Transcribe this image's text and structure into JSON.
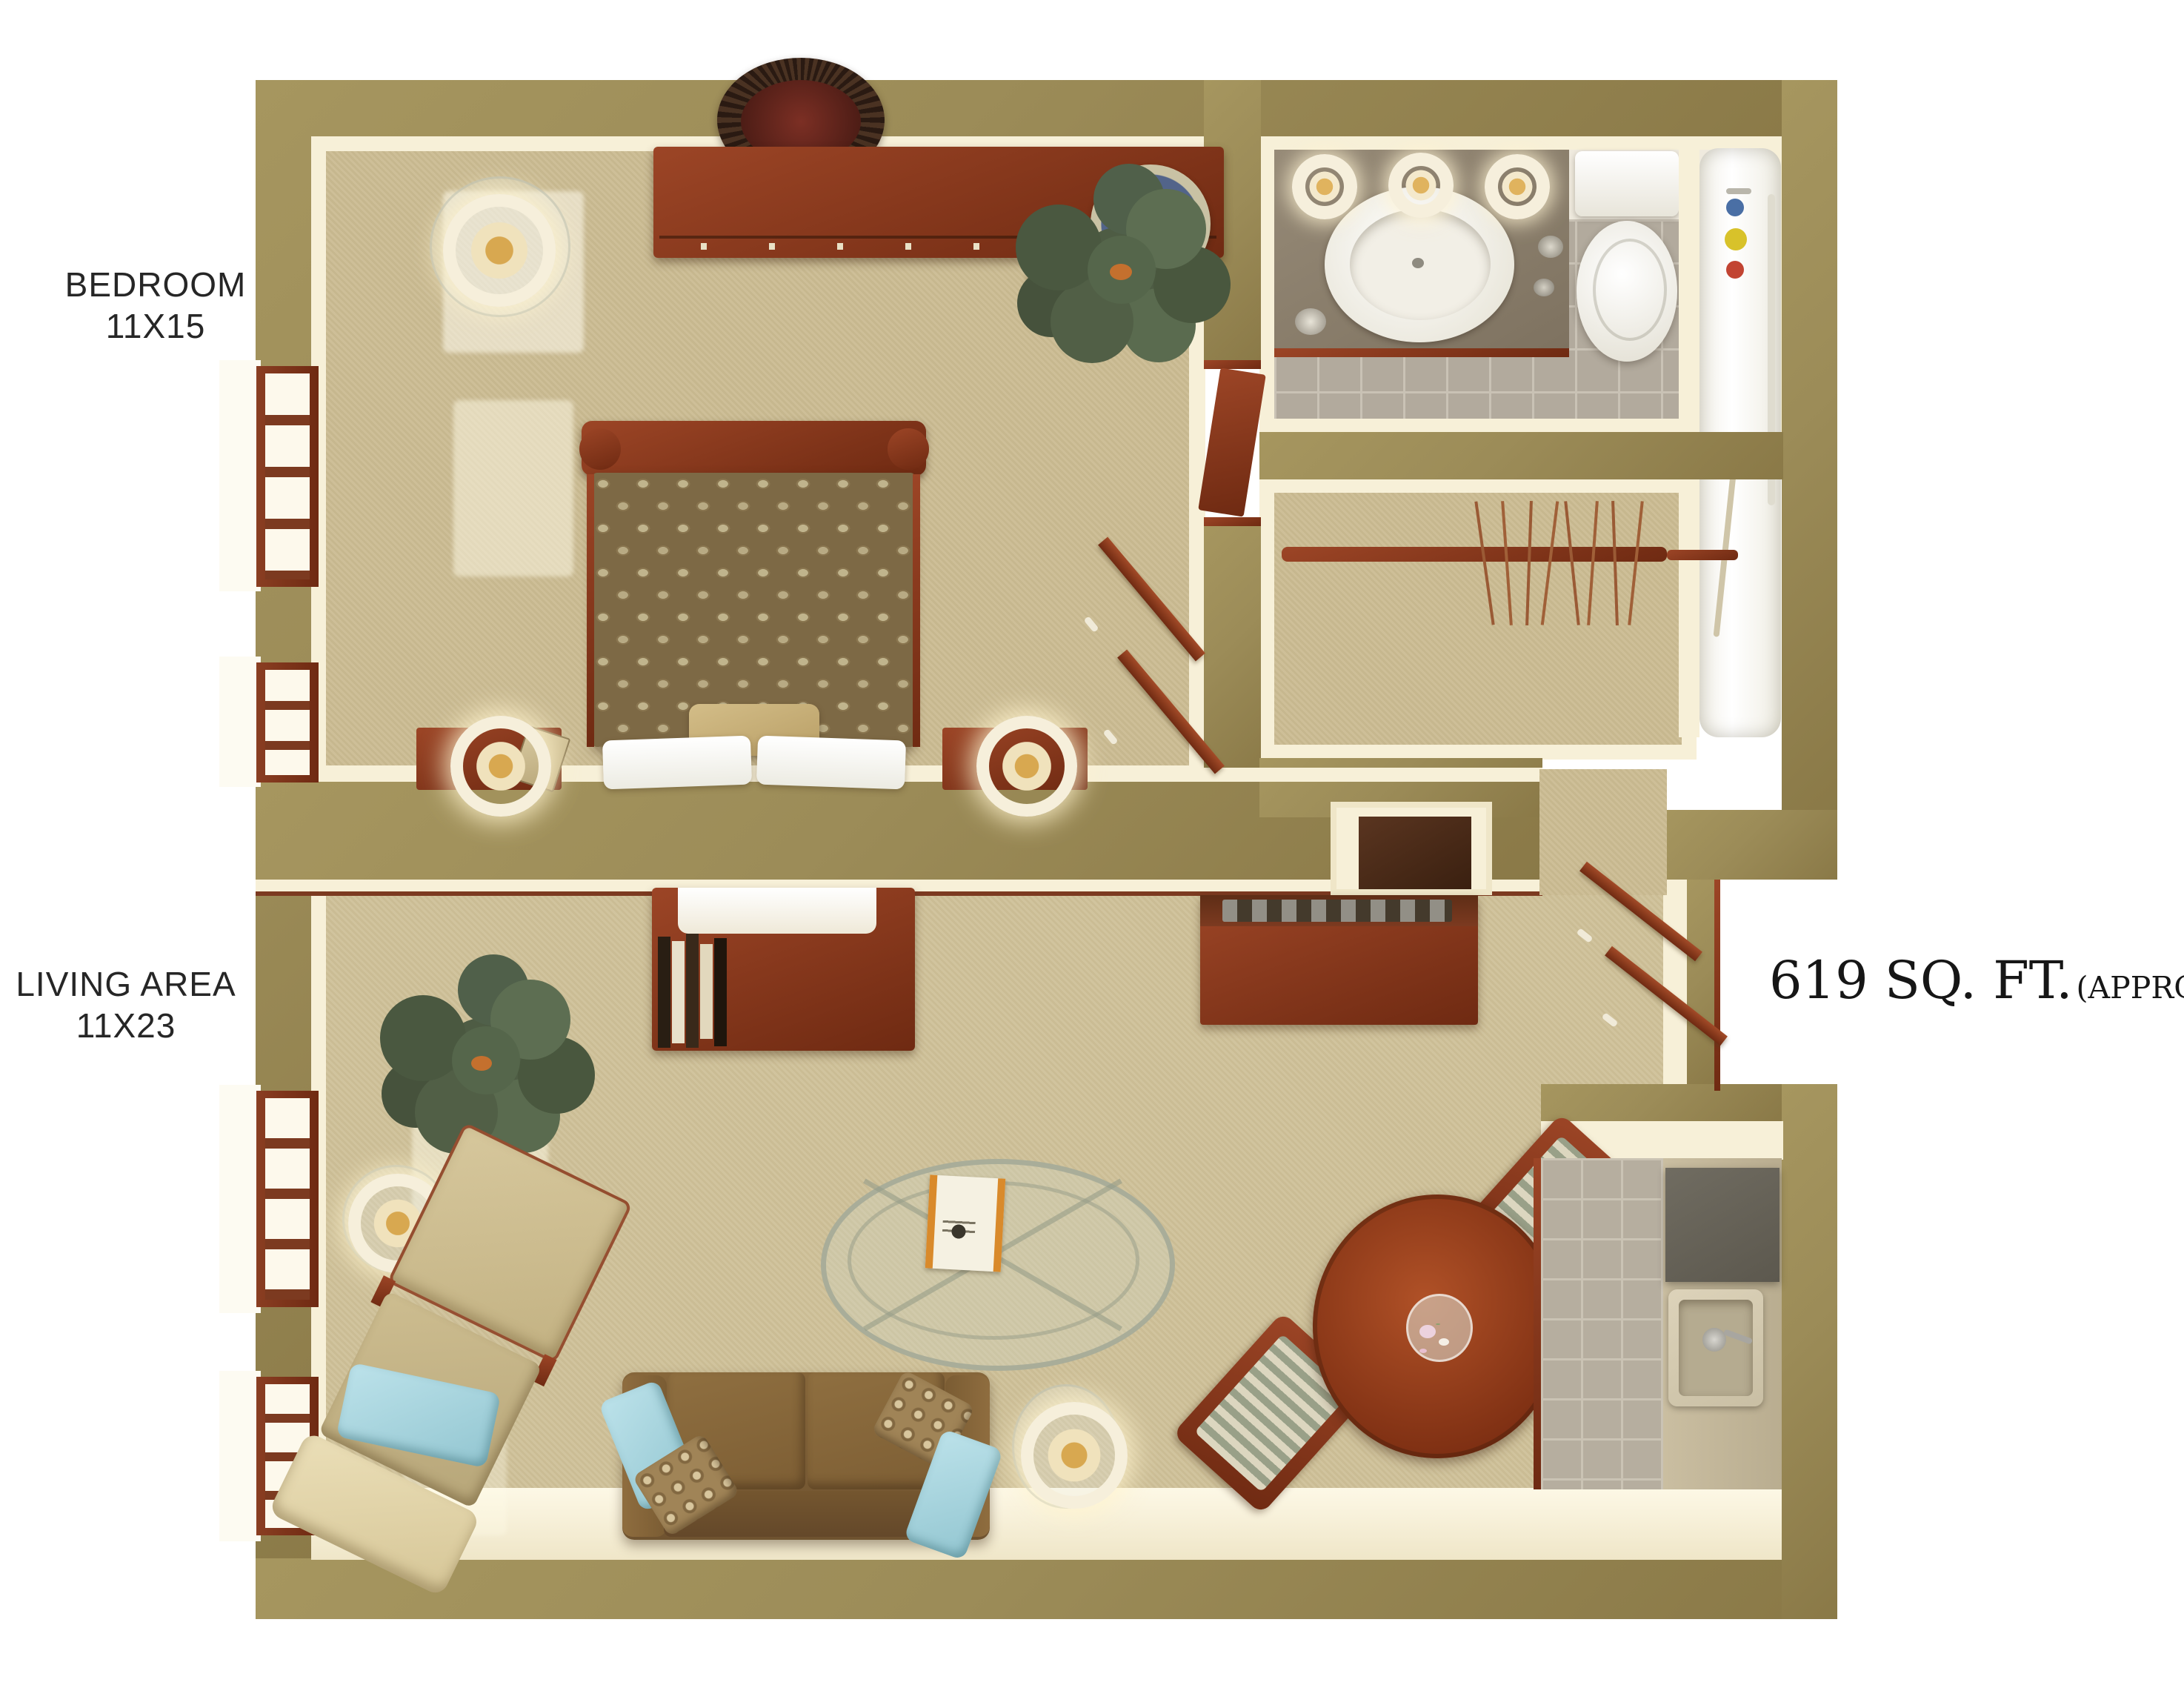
{
  "page": {
    "background": "#ffffff",
    "type": "3d-top-down-apartment-floor-plan"
  },
  "labels": {
    "bedroom": {
      "name": "BEDROOM",
      "dims": "11X15"
    },
    "living_area": {
      "name": "LIVING AREA",
      "dims": "11X23"
    },
    "area": {
      "value": "619 SQ. FT.",
      "qualifier": "(APPROX.)"
    }
  },
  "floor_plan": {
    "rooms": [
      {
        "id": "bedroom",
        "label": "BEDROOM",
        "dimensions": "11X15",
        "floor": "carpet"
      },
      {
        "id": "living-area",
        "label": "LIVING AREA",
        "dimensions": "11X23",
        "floor": "carpet"
      },
      {
        "id": "bathroom",
        "floor": "tile"
      },
      {
        "id": "closet",
        "floor": "carpet"
      },
      {
        "id": "kitchen",
        "floor": "tile"
      },
      {
        "id": "entry",
        "floor": "carpet"
      }
    ],
    "furniture": {
      "bedroom": [
        "dresser",
        "decorative-plates",
        "ceiling-medallion",
        "bed-with-patterned-comforter",
        "white-pillows",
        "accent-pillow",
        "nightstand-left",
        "nightstand-right",
        "table-lamps",
        "floor-lamp",
        "potted-plant",
        "wall-shelves",
        "windows"
      ],
      "bathroom": [
        "vanity-counter",
        "oval-sink",
        "vanity-lights",
        "soap-dishes",
        "toilet",
        "bathtub",
        "shower-caddy",
        "grab-bar",
        "towels"
      ],
      "closet": [
        "hanging-rod",
        "clothes-hangers"
      ],
      "living_area": [
        "writing-desk",
        "books",
        "paper-blotter",
        "console-table",
        "alcove-cabinet",
        "floor-lamps",
        "potted-plant",
        "recliner-with-footrest",
        "loveseat-sofa",
        "blue-throw-pillows",
        "patterned-throw-pillows",
        "oval-glass-coffee-table",
        "magazine",
        "round-dining-table",
        "flower-vase",
        "dining-chairs",
        "entry-wall-shelves",
        "windows"
      ],
      "kitchen": [
        "counter",
        "range-top",
        "kitchen-sink",
        "faucet"
      ]
    },
    "colors": {
      "wall": "#9c8c58",
      "wall_inner_face": "#f7f0d8",
      "carpet": "#cfc199",
      "cherry_wood": "#8c3b20",
      "sofa_brown": "#82613a",
      "recliner_tan": "#cfc095",
      "accent_blue": "#a9d8e0",
      "bath_tile": "#b2aa9d",
      "dining_table_wood": "#96391c",
      "counter_taupe": "#8b7e6c",
      "text": "#262626"
    }
  }
}
